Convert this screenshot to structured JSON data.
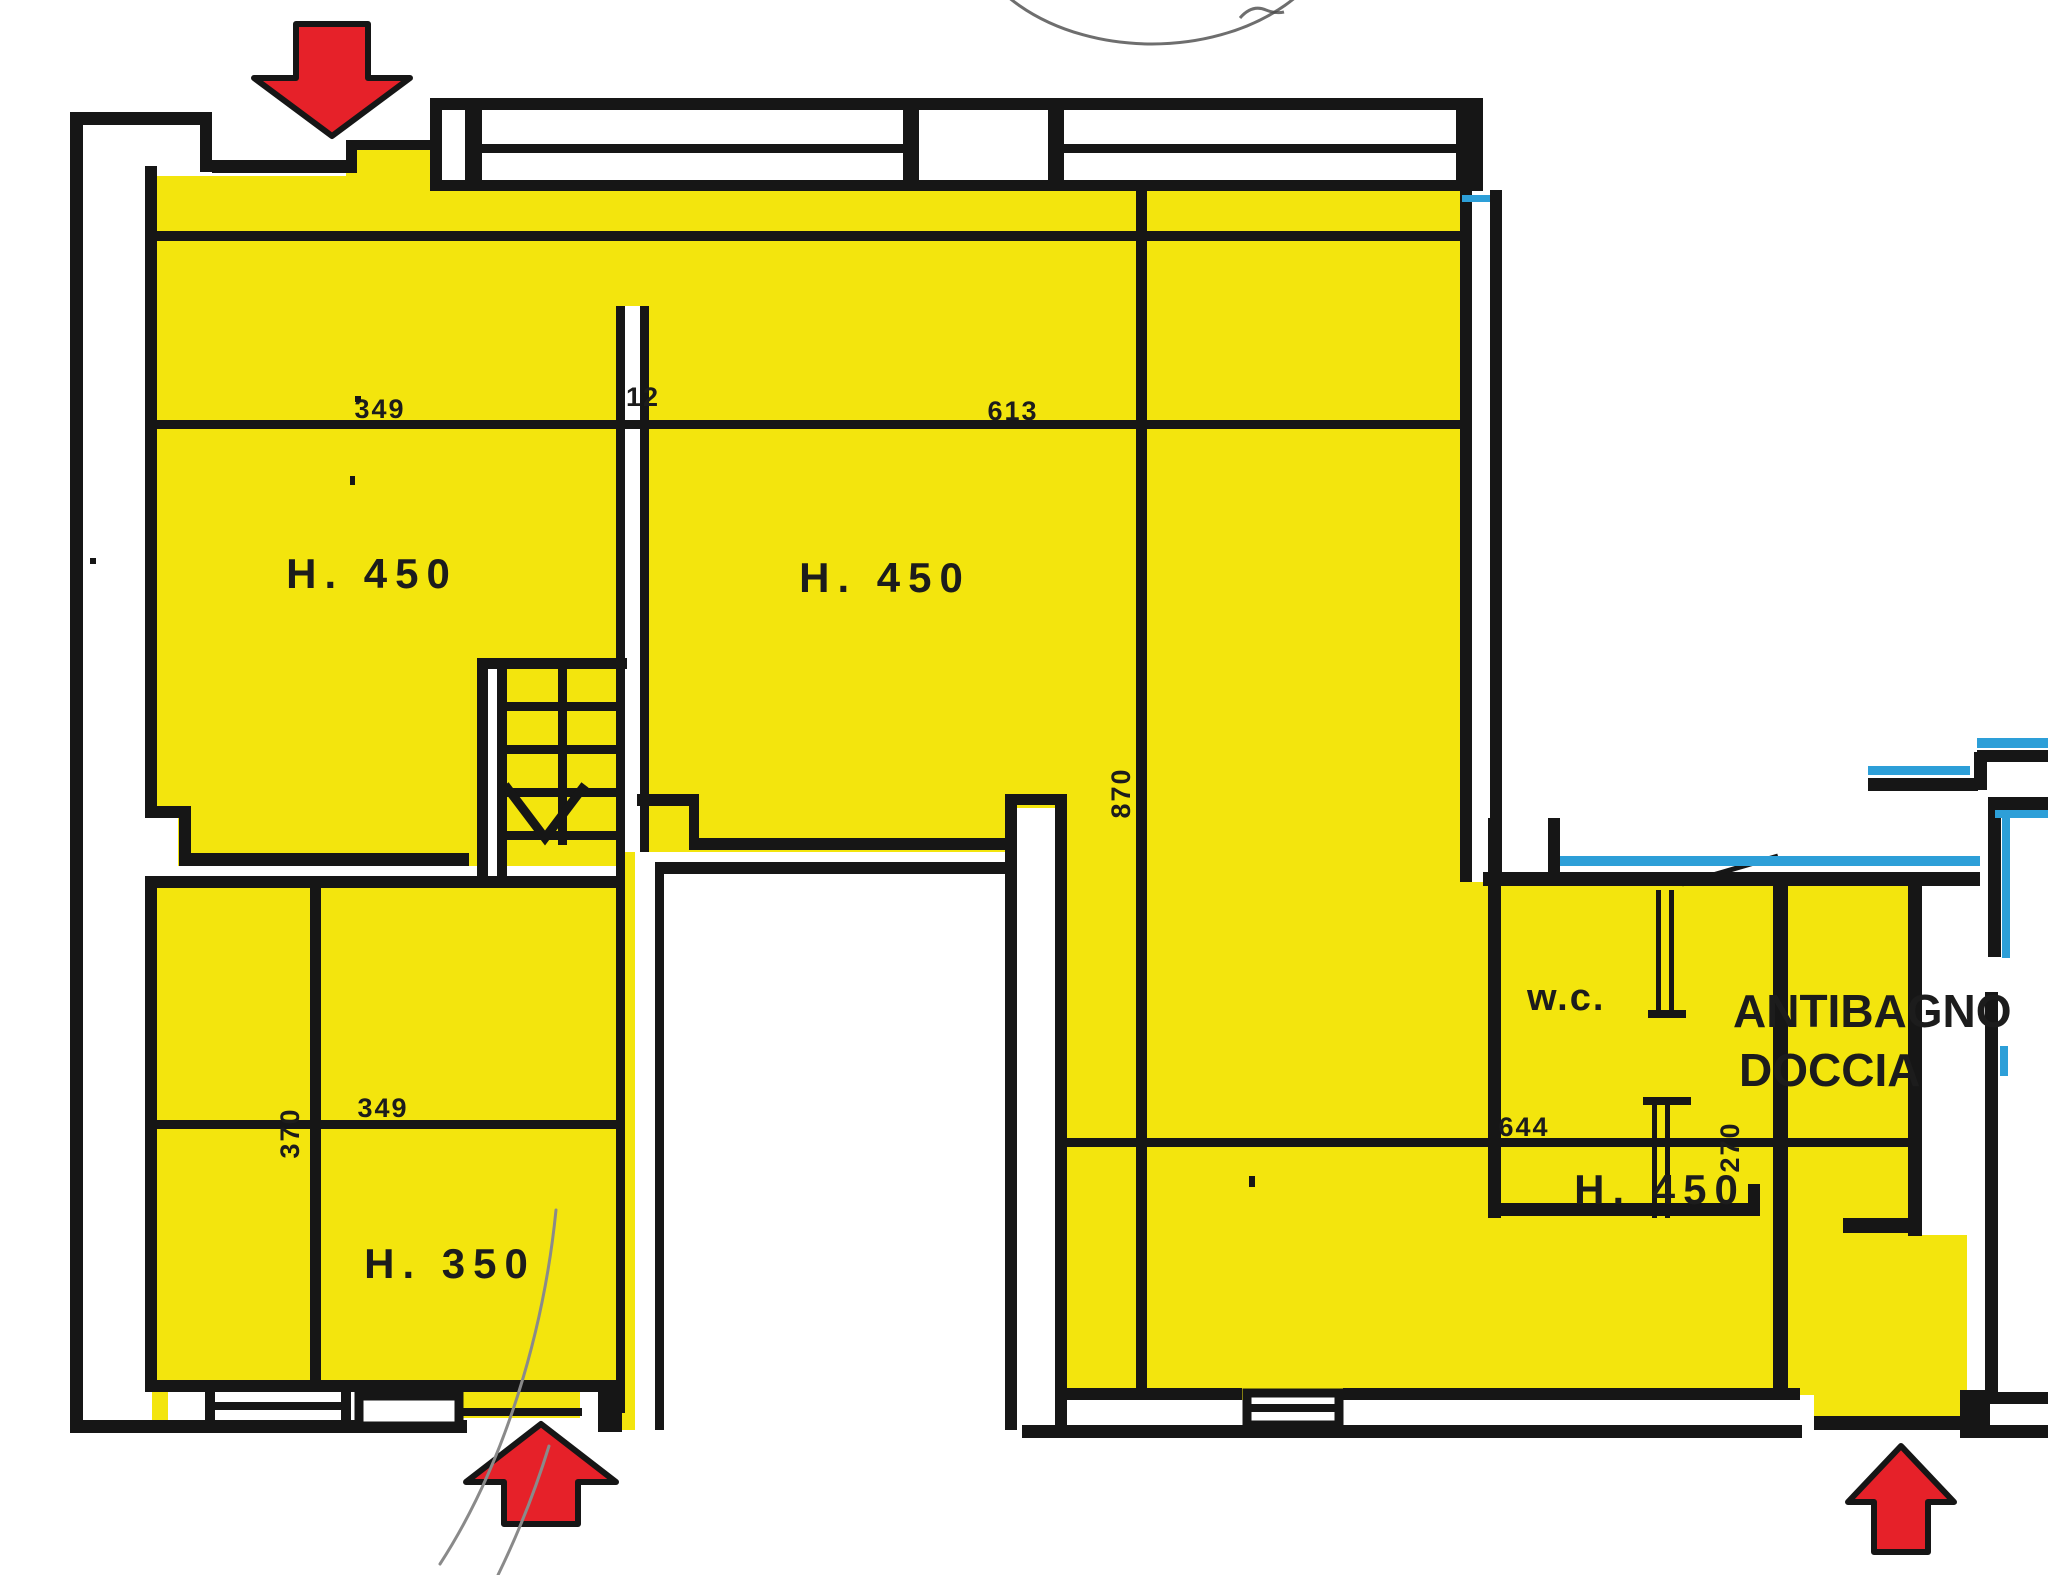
{
  "colors": {
    "highlight": "#F3E50D",
    "arrow": "#E62129",
    "ink": "#161616",
    "blue": "#2D9FD8",
    "paper": "#FFFFFF",
    "pen": "#8A8A8A",
    "stamp": "#4A4A4A"
  },
  "rooms": {
    "upper_left": {
      "height_label": "H. 450"
    },
    "upper_center": {
      "height_label": "H. 450"
    },
    "lower_left": {
      "height_label": "H. 350"
    },
    "bath": {
      "height_label": "H. 450"
    },
    "wc": {
      "label": "w.c."
    },
    "antibagno": {
      "label_line1": "ANTIBAGNO",
      "label_line2": "DOCCIA"
    }
  },
  "dimensions": {
    "top_left_width": "349",
    "partition_thickness": "12",
    "top_center_width": "613",
    "center_depth": "870",
    "lower_left_width": "349",
    "lower_left_depth": "370",
    "bath_width": "644",
    "bath_right_depth": "270"
  },
  "arrows": {
    "top": {
      "direction": "down"
    },
    "bottom_left": {
      "direction": "up"
    },
    "bottom_right": {
      "direction": "up"
    }
  }
}
